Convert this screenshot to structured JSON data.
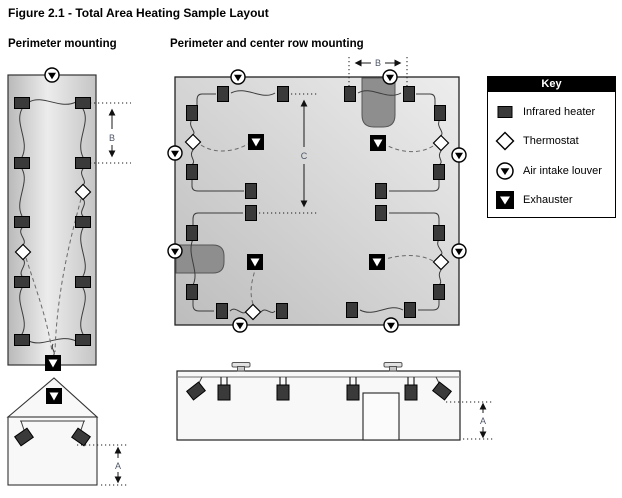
{
  "figure": {
    "title": "Figure 2.1 - Total Area Heating Sample Layout"
  },
  "sections": {
    "left": {
      "subtitle": "Perimeter mounting"
    },
    "middle": {
      "subtitle": "Perimeter and center row mounting"
    }
  },
  "dimensions": {
    "A": "A",
    "B": "B",
    "C": "C"
  },
  "key": {
    "header": "Key",
    "items": [
      {
        "icon": "infrared-heater-icon",
        "label": "Infrared heater"
      },
      {
        "icon": "thermostat-icon",
        "label": "Thermostat"
      },
      {
        "icon": "air-intake-louver-icon",
        "label": "Air intake louver"
      },
      {
        "icon": "exhauster-icon",
        "label": "Exhauster"
      }
    ]
  },
  "colors": {
    "heater": "#3a3a3a",
    "line": "#3c3c3c",
    "dashed": "#6a6a6a",
    "obstruction": "#8e8e8e",
    "elev": "#f8f8f8",
    "dim-text": "#4d5566",
    "key-bg": "#000000",
    "plan-dark": "#bfbfbf",
    "plan-light": "#ededed"
  },
  "markers": {
    "left_plan": [
      {
        "type": "louver",
        "x": 52,
        "y": 75
      },
      {
        "type": "heater",
        "x": 22,
        "y": 103
      },
      {
        "type": "heater",
        "x": 83,
        "y": 103
      },
      {
        "type": "heater",
        "x": 22,
        "y": 163
      },
      {
        "type": "heater",
        "x": 83,
        "y": 163
      },
      {
        "type": "heater",
        "x": 22,
        "y": 222
      },
      {
        "type": "heater",
        "x": 83,
        "y": 222
      },
      {
        "type": "heater",
        "x": 22,
        "y": 282
      },
      {
        "type": "heater",
        "x": 83,
        "y": 282
      },
      {
        "type": "heater",
        "x": 22,
        "y": 340
      },
      {
        "type": "heater",
        "x": 83,
        "y": 340
      },
      {
        "type": "thermostat",
        "x": 83,
        "y": 192
      },
      {
        "type": "thermostat",
        "x": 23,
        "y": 252
      },
      {
        "type": "exhauster",
        "x": 53,
        "y": 363
      }
    ],
    "middle_plan": [
      {
        "type": "louver",
        "x": 238,
        "y": 77
      },
      {
        "type": "louver",
        "x": 390,
        "y": 77
      },
      {
        "type": "louver",
        "x": 175,
        "y": 153
      },
      {
        "type": "louver",
        "x": 175,
        "y": 251
      },
      {
        "type": "louver",
        "x": 459,
        "y": 155
      },
      {
        "type": "louver",
        "x": 459,
        "y": 251
      },
      {
        "type": "louver",
        "x": 240,
        "y": 325
      },
      {
        "type": "louver",
        "x": 391,
        "y": 325
      },
      {
        "type": "heater",
        "x": 223,
        "y": 94,
        "r": 90
      },
      {
        "type": "heater",
        "x": 283,
        "y": 94,
        "r": 90
      },
      {
        "type": "heater",
        "x": 350,
        "y": 94,
        "r": 90
      },
      {
        "type": "heater",
        "x": 409,
        "y": 94,
        "r": 90
      },
      {
        "type": "heater",
        "x": 192,
        "y": 113,
        "r": 90
      },
      {
        "type": "heater",
        "x": 192,
        "y": 172,
        "r": 90
      },
      {
        "type": "heater",
        "x": 192,
        "y": 233,
        "r": 90
      },
      {
        "type": "heater",
        "x": 192,
        "y": 292,
        "r": 90
      },
      {
        "type": "heater",
        "x": 440,
        "y": 113,
        "r": 90
      },
      {
        "type": "heater",
        "x": 439,
        "y": 172,
        "r": 90
      },
      {
        "type": "heater",
        "x": 439,
        "y": 233,
        "r": 90
      },
      {
        "type": "heater",
        "x": 439,
        "y": 292,
        "r": 90
      },
      {
        "type": "heater",
        "x": 251,
        "y": 191,
        "r": 90
      },
      {
        "type": "heater",
        "x": 381,
        "y": 191,
        "r": 90
      },
      {
        "type": "heater",
        "x": 251,
        "y": 213,
        "r": 90
      },
      {
        "type": "heater",
        "x": 381,
        "y": 213,
        "r": 90
      },
      {
        "type": "heater",
        "x": 222,
        "y": 311,
        "r": 90
      },
      {
        "type": "heater",
        "x": 282,
        "y": 311,
        "r": 90
      },
      {
        "type": "heater",
        "x": 352,
        "y": 310,
        "r": 90
      },
      {
        "type": "heater",
        "x": 410,
        "y": 310,
        "r": 90
      },
      {
        "type": "thermostat",
        "x": 193,
        "y": 142
      },
      {
        "type": "thermostat",
        "x": 441,
        "y": 143
      },
      {
        "type": "thermostat",
        "x": 253,
        "y": 312
      },
      {
        "type": "thermostat",
        "x": 441,
        "y": 262
      },
      {
        "type": "exhauster",
        "x": 256,
        "y": 142
      },
      {
        "type": "exhauster",
        "x": 378,
        "y": 143
      },
      {
        "type": "exhauster",
        "x": 255,
        "y": 262
      },
      {
        "type": "exhauster",
        "x": 377,
        "y": 262
      }
    ],
    "left_elevation": [
      {
        "type": "exhauster",
        "x": 54,
        "y": 396
      },
      {
        "type": "heater",
        "x": 24,
        "y": 437,
        "r": -35
      },
      {
        "type": "heater",
        "x": 81,
        "y": 437,
        "r": 35
      }
    ],
    "middle_elevation": [
      {
        "type": "roofvent",
        "x": 241,
        "y": 371
      },
      {
        "type": "roofvent",
        "x": 393,
        "y": 371
      },
      {
        "type": "hangheater",
        "x": 224,
        "y": 377
      },
      {
        "type": "hangheater",
        "x": 283,
        "y": 377
      },
      {
        "type": "hangheater",
        "x": 353,
        "y": 377
      },
      {
        "type": "hangheater",
        "x": 411,
        "y": 377
      },
      {
        "type": "heater",
        "x": 196,
        "y": 391,
        "r": -38
      },
      {
        "type": "heater",
        "x": 442,
        "y": 391,
        "r": 38
      }
    ]
  }
}
